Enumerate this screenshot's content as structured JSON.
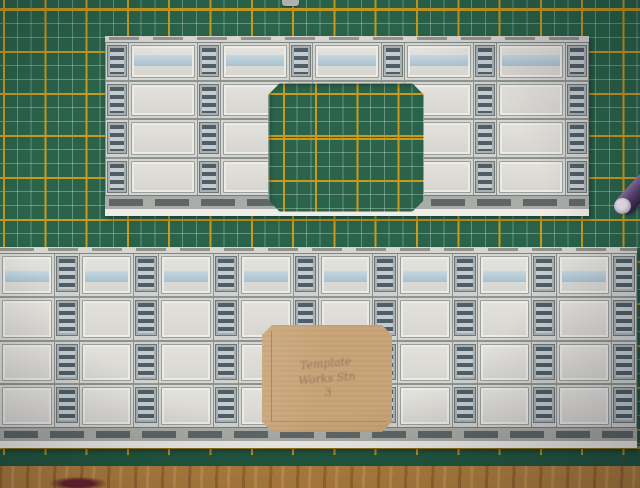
{
  "scene": {
    "description": "Two printed card model-railway wall strips with louvred vent panels laid on a green self-healing cutting mat with yellow grid lines; the upper strip has a large chamfered rectangular opening cut out; a square cardboard template with faint pencil writing lies on the lower strip; a purple pen cap enters from the right edge; a wooden desk shows along the bottom."
  },
  "note": {
    "line1": "Template",
    "line2": "Works Stn",
    "line3": "3"
  },
  "objects": {
    "mat": "green cutting mat with yellow grid",
    "upper_piece": "card wall strip with cut-out doorway",
    "lower_piece": "long card wall strip",
    "cardboard": "square cardboard template with pencil note",
    "tool": "purple pen cap",
    "desk": "wooden desk surface"
  },
  "colors": {
    "mat_green": "#2a634a",
    "mat_green_dark": "#235841",
    "grid_yellow": "#c79a1c",
    "card_bg": "#d7d5d0",
    "band_blue": "#a2bfce",
    "vent_dark": "#4e5d66",
    "vent_light": "#c4cccf",
    "cardboard": "#c9a478",
    "wood": "#b5823f",
    "purple": "#5a4370"
  },
  "pieces": [
    {
      "name": "upper-wall-strip",
      "left": 105,
      "top": 36,
      "width": 484,
      "height": 180,
      "rows": 4,
      "vent_width": 22,
      "band_row": 0,
      "band_top": "30%",
      "columns": [
        "v",
        "p",
        "v",
        "p",
        "v",
        "p",
        "v",
        "p",
        "v",
        "p",
        "v"
      ]
    },
    {
      "name": "lower-wall-strip",
      "left": 0,
      "top": 247,
      "width": 637,
      "height": 201,
      "rows": 4,
      "vent_width": 24,
      "band_row": 0,
      "band_top": "40%",
      "columns": [
        "p",
        "v",
        "p",
        "v",
        "p",
        "v",
        "p",
        "v",
        "p",
        "v",
        "p",
        "v",
        "p",
        "v",
        "p",
        "v"
      ]
    }
  ],
  "cutout": {
    "left": 268,
    "top": 83,
    "width": 156,
    "height": 129,
    "chamfer": 12
  },
  "cardboard_shape": {
    "left": 262,
    "top": 325,
    "width": 130,
    "height": 107,
    "chamfer": 10
  }
}
